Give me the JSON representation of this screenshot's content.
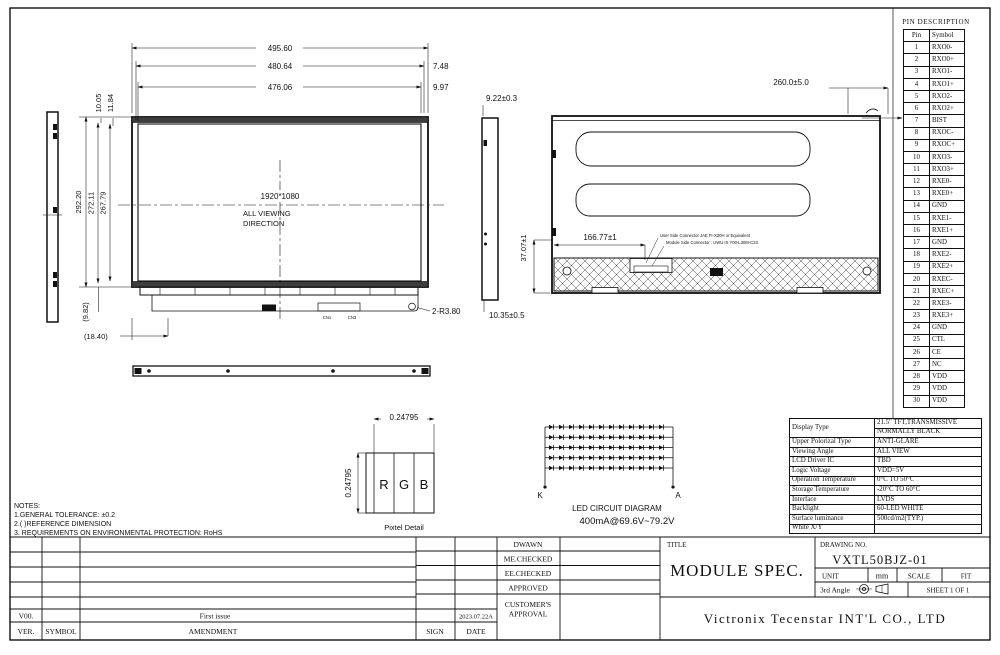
{
  "pin_table": {
    "title": "PIN  DESCRIPTION",
    "headers": [
      "Pin",
      "Symbol"
    ],
    "rows": [
      [
        "1",
        "RXO0-"
      ],
      [
        "2",
        "RXO0+"
      ],
      [
        "3",
        "RXO1-"
      ],
      [
        "4",
        "RXO1+"
      ],
      [
        "5",
        "RXO2-"
      ],
      [
        "6",
        "RXO2+"
      ],
      [
        "7",
        "BIST"
      ],
      [
        "8",
        "RXOC-"
      ],
      [
        "9",
        "RXOC+"
      ],
      [
        "10",
        "RXO3-"
      ],
      [
        "11",
        "RXO3+"
      ],
      [
        "12",
        "RXE0-"
      ],
      [
        "13",
        "RXE0+"
      ],
      [
        "14",
        "GND"
      ],
      [
        "15",
        "RXE1-"
      ],
      [
        "16",
        "RXE1+"
      ],
      [
        "17",
        "GND"
      ],
      [
        "18",
        "RXE2-"
      ],
      [
        "19",
        "RXE2+"
      ],
      [
        "20",
        "RXEC-"
      ],
      [
        "21",
        "RXEC+"
      ],
      [
        "22",
        "RXE3-"
      ],
      [
        "23",
        "RXE3+"
      ],
      [
        "24",
        "GND"
      ],
      [
        "25",
        "CTL"
      ],
      [
        "26",
        "CE"
      ],
      [
        "27",
        "NC"
      ],
      [
        "28",
        "VDD"
      ],
      [
        "29",
        "VDD"
      ],
      [
        "30",
        "VDD"
      ]
    ]
  },
  "spec_table": {
    "rows": [
      {
        "label": "Display Type",
        "value": "21.5\" TFT,TRANSMISSIVE",
        "value2": "NORMALLY BLACK"
      },
      {
        "label": "Upper Polorizal Type",
        "value": "ANTI-GLARE"
      },
      {
        "label": "Viewing Angle",
        "value": "ALL VIEW"
      },
      {
        "label": "LCD Driver IC",
        "value": "TBD"
      },
      {
        "label": "Logic Voltage",
        "value": "VDD=5V"
      },
      {
        "label": "Operation Temperature",
        "value": "0°C TO 50°C"
      },
      {
        "label": "Storage Temperature",
        "value": "-20°C TO 60°C"
      },
      {
        "label": "Interface",
        "value": "LVDS"
      },
      {
        "label": "Backlight",
        "value": "60-LED WHITE"
      },
      {
        "label": "Surface luminance",
        "value": "500cd/m2(TYP.)"
      },
      {
        "label": "White X/Y",
        "value": ""
      }
    ]
  },
  "front_view": {
    "dim_width_outer": "495.60",
    "dim_width_mid": "480.64",
    "dim_width_inner": "476.06",
    "dim_offset_mid": "7.48",
    "dim_offset_inner": "9.97",
    "dim_top1": "10.05",
    "dim_top2": "11.84",
    "dim_height_outer": "292.20",
    "dim_height_mid": "272.11",
    "dim_height_inner": "267.79",
    "dim_ref_height": "(9.82)",
    "dim_ref_offset": "(18.40)",
    "resolution": "1920*1080",
    "viewing_line1": "ALL  VIEWING",
    "viewing_line2": "DIRECTION",
    "corner_note": "2-R3.80",
    "connector1": "CN1",
    "connector2": "CN3"
  },
  "rear_view": {
    "dim_thickness": "9.22±0.3",
    "dim_width": "260.0±5.0",
    "dim_connector_x": "166.77±1",
    "dim_connector_y": "37.07±1",
    "dim_bottom": "10.35±0.5",
    "note_user": "User Side Connector JAE FI-X30H or Equivalent",
    "note_module": "Module Side Connector : UWU IS Y00-L30M-C23"
  },
  "pixel_detail": {
    "dim_h": "0.24795",
    "dim_v": "0.24795",
    "r": "R",
    "g": "G",
    "b": "B",
    "caption": "Pixtel  Detail"
  },
  "led_circuit": {
    "rows": 5,
    "per_row": 12,
    "k": "K",
    "a": "A",
    "title": "LED  CIRCUIT  DIAGRAM",
    "subtitle": "400mA@69.6V~79.2V"
  },
  "notes": {
    "title": "NOTES:",
    "items": [
      "1.GENERAL  TOLERANCE: ±0.2",
      "2.(   )REFERENCE  DIMENSION",
      "3.  REQUIREMENTS  ON  ENVIRONMENTAL  PROTECTION:  RoHS"
    ]
  },
  "revision_table": {
    "ver": "V00.",
    "first_issue": "First  issue",
    "col_ver": "VER.",
    "col_symbol": "SYMBOL",
    "col_amendment": "AMENDMENT"
  },
  "approval_table": {
    "drawn": "DWAWN",
    "me_checked": "ME.CHECKED",
    "ee_checked": "EE.CHECKED",
    "approved": "APPROVED",
    "customer_line1": "CUSTOMER'S",
    "customer_line2": "APPROVAL",
    "date_value": "2023.07.22A",
    "sign": "SIGN",
    "date": "DATE"
  },
  "title_block": {
    "title_label": "TITLE",
    "title": "MODULE  SPEC.",
    "drawing_no_label": "DRAWING  NO.",
    "drawing_no": "VXTL50BJZ-01",
    "unit_label": "UNIT",
    "unit": "mm",
    "scale_label": "SCALE",
    "scale": "FIT",
    "angle": "3rd  Angle",
    "sheet": "SHEET  1  OF  1",
    "company": "Victronix  Tecenstar  INT'L  CO.,  LTD"
  }
}
